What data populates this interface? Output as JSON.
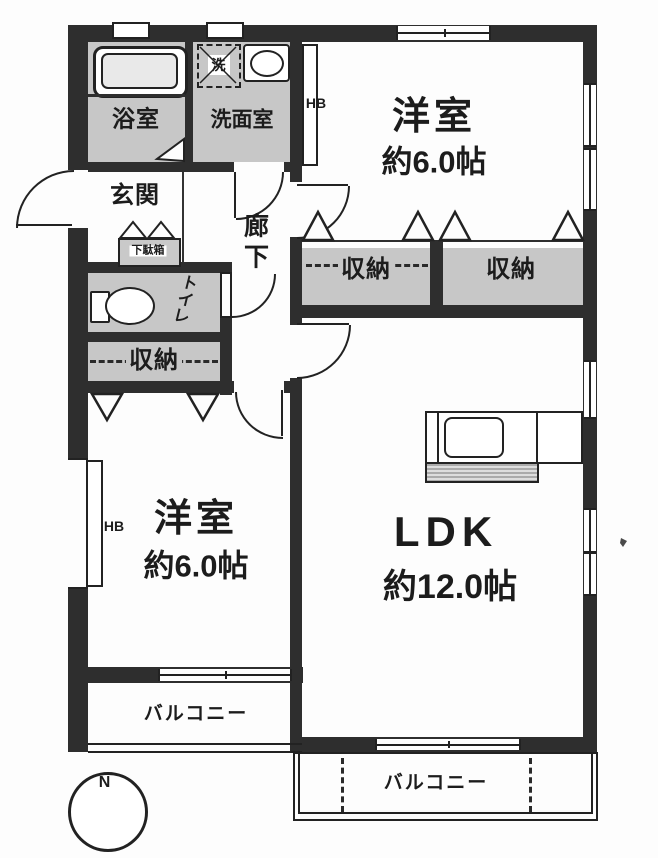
{
  "colors": {
    "wall": "#2e2e2e",
    "room_gray": "#c7c7c7",
    "paper": "#fdfdfd",
    "line": "#222222"
  },
  "rooms": {
    "bath": "浴室",
    "washroom": "洗面室",
    "washer": "洗",
    "hb_top": "HB",
    "hb_left": "HB",
    "bedroom_top": {
      "name": "洋室",
      "size": "約6.0帖"
    },
    "bedroom_left": {
      "name": "洋室",
      "size": "約6.0帖"
    },
    "ldk": {
      "name": "LDK",
      "size": "約12.0帖"
    },
    "closet_top_left": "収納",
    "closet_top_right": "収納",
    "closet_left": "収納",
    "entrance": "玄関",
    "shoe_cabinet": "下駄箱",
    "corridor": [
      "廊",
      "下"
    ],
    "toilet": [
      "ト",
      "イ",
      "レ"
    ],
    "balcony_left": "バルコニー",
    "balcony_bottom": "バルコニー"
  },
  "compass": {
    "north": "N"
  }
}
